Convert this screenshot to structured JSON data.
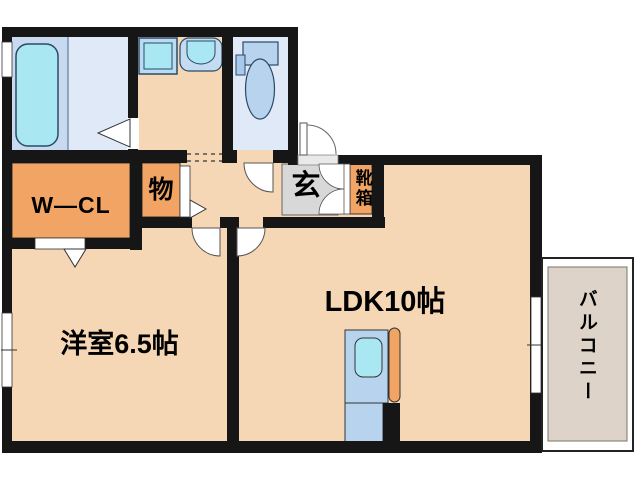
{
  "floorplan": {
    "title": "1LDK apartment floor plan",
    "rooms": {
      "wcl": "W—CL",
      "storage": "物",
      "entrance": "玄",
      "shoebox": "靴箱",
      "western": "洋室6.5帖",
      "ldk": "LDK10帖",
      "balcony": "バルコニー"
    },
    "fixtures": [
      "bathtub",
      "washing-machine-pan",
      "vanity-sink",
      "toilet",
      "kitchen-counter",
      "kitchen-sink",
      "entrance-door",
      "shoe-cabinet-doors"
    ],
    "colors": {
      "wall": "#161616",
      "floor_peach": "#f6d7b5",
      "closet_orange": "#f1a463",
      "wet_room_blue": "#dfe9f8",
      "bath_zone_blue": "#c8daef",
      "fixture_blue": "#b8d3ee",
      "water_cyan": "#a9e8f3",
      "entrance_gray": "#d8d8d8",
      "balcony_beige": "#ddd3c8",
      "threshold_gray": "#e9e9e9"
    }
  }
}
